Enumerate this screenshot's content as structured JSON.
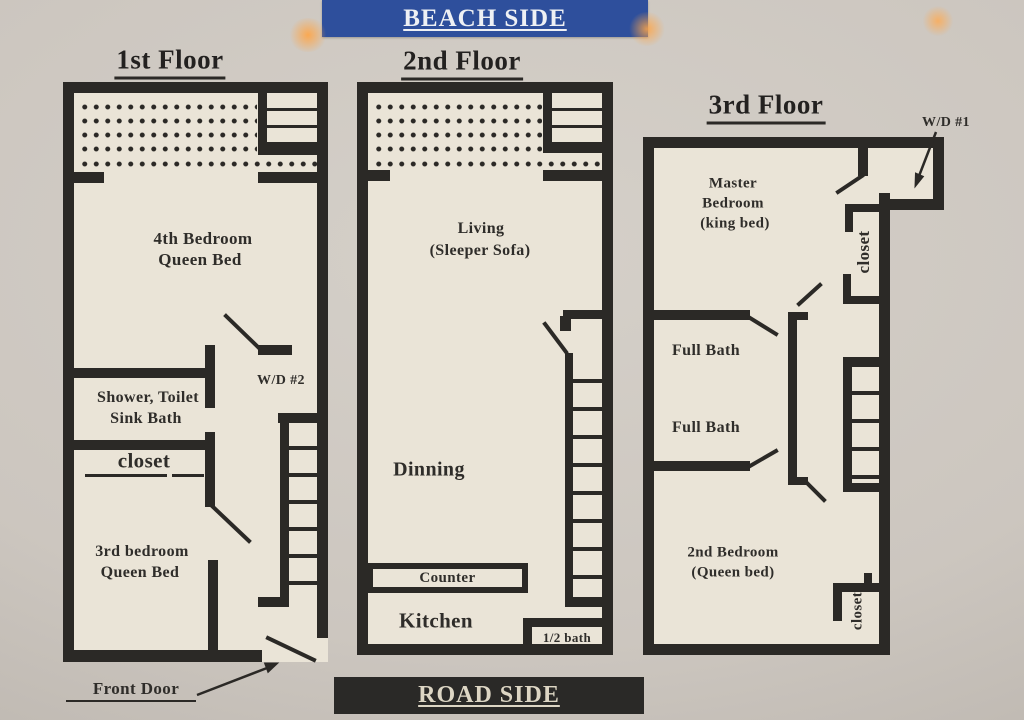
{
  "banners": {
    "beach": "BEACH SIDE",
    "road": "ROAD SIDE"
  },
  "floors": {
    "f1": {
      "title": "1st Floor",
      "bedroom4_line1": "4th Bedroom",
      "bedroom4_line2": "Queen Bed",
      "bath_line1": "Shower, Toilet",
      "bath_line2": "Sink Bath",
      "closet": "closet",
      "bedroom3_line1": "3rd bedroom",
      "bedroom3_line2": "Queen Bed",
      "washer_dryer": "W/D #2",
      "front_door": "Front Door"
    },
    "f2": {
      "title": "2nd Floor",
      "living_line1": "Living",
      "living_line2": "(Sleeper Sofa)",
      "dining": "Dinning",
      "counter": "Counter",
      "kitchen": "Kitchen",
      "half_bath": "1/2 bath"
    },
    "f3": {
      "title": "3rd Floor",
      "washer_dryer": "W/D #1",
      "master_line1": "Master",
      "master_line2": "Bedroom",
      "master_line3": "(king bed)",
      "closet_upper": "closet",
      "full_bath_upper": "Full Bath",
      "full_bath_lower": "Full Bath",
      "bedroom2_line1": "2nd Bedroom",
      "bedroom2_line2": "(Queen bed)",
      "closet_lower": "closet"
    }
  }
}
